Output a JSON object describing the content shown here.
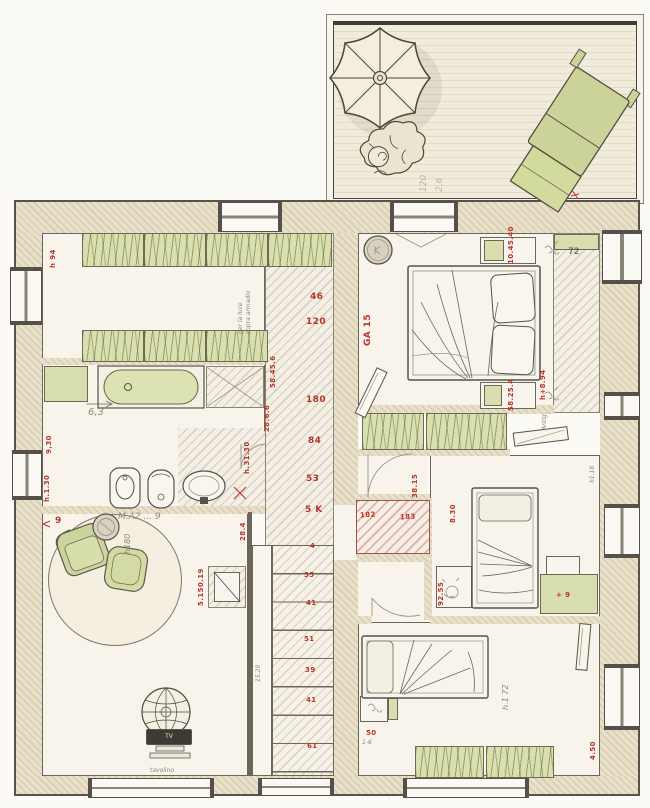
{
  "terrace": {
    "dim_a": "120",
    "dim_b": "2,6"
  },
  "closet": {
    "height": "h 94",
    "note1": "per la luce",
    "note2": "sopra armadio"
  },
  "column": {
    "d1": "46",
    "d2": "120",
    "v1": "58.45.6",
    "v2": "28.6.6",
    "d3": "180",
    "d4": "84",
    "d5": "53",
    "d6": "5 K"
  },
  "bath": {
    "width": "6,3",
    "left_top": "9,30",
    "left_bottom": "h.1.30",
    "right": "h.31.30"
  },
  "living": {
    "corner": "9",
    "note": "M.A2 ... 9",
    "height": "h180",
    "right": "28.4",
    "cabinet": "5.150.19",
    "tv": "TV",
    "tv_note": "tavolino"
  },
  "stairs": {
    "s1": "4",
    "s2": "35",
    "s3": "41",
    "s4": "51",
    "s5": "39",
    "s6": "41",
    "s7": "61",
    "note": "15.29"
  },
  "bedroom1": {
    "code": "GA 15",
    "ns_top": "10.45.40",
    "ns_bottom": "58.25.4",
    "right_h": "h+8.94",
    "right_note": "Antig.",
    "strip": "72"
  },
  "hall": {
    "dim": "38.15",
    "niche_l": "182",
    "niche_r": "183",
    "dim2": "8.30"
  },
  "bedroom2": {
    "desk": "92.55",
    "dresser": "+ 9",
    "shelf": "h1.18"
  },
  "bedroom3": {
    "red": "50",
    "pencil": "1-6",
    "height": "h.1 72",
    "right": "4.50"
  }
}
